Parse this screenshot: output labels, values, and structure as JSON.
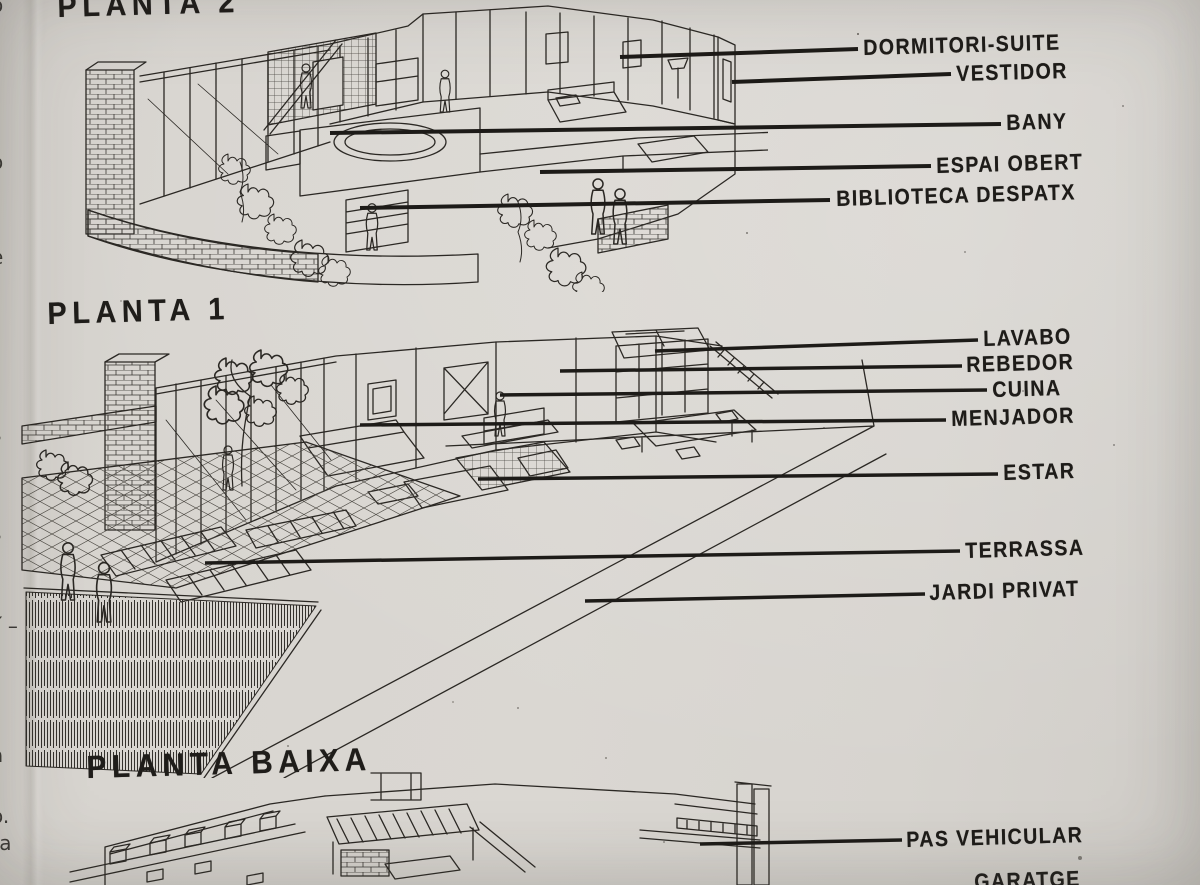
{
  "document": {
    "kind": "scanned architectural book page",
    "language": "Catalan"
  },
  "colors": {
    "paper": "#d7d4cf",
    "ink": "#2a2723",
    "leader_line": "#1d1b18"
  },
  "sections": [
    {
      "id": "planta-2",
      "title": "PLANTA 2",
      "labels": [
        {
          "text": "DORMITORI-SUITE"
        },
        {
          "text": "VESTIDOR"
        },
        {
          "text": "BANY"
        },
        {
          "text": "ESPAI OBERT"
        },
        {
          "text": "BIBLIOTECA DESPATX"
        }
      ]
    },
    {
      "id": "planta-1",
      "title": "PLANTA 1",
      "labels": [
        {
          "text": "LAVABO"
        },
        {
          "text": "REBEDOR"
        },
        {
          "text": "CUINA"
        },
        {
          "text": "MENJADOR"
        },
        {
          "text": "ESTAR"
        },
        {
          "text": "TERRASSA"
        },
        {
          "text": "JARDI PRIVAT"
        }
      ]
    },
    {
      "id": "planta-baixa",
      "title": "PLANTA BAIXA",
      "labels": [
        {
          "text": "PAS VEHICULAR"
        },
        {
          "text": "GARATGE"
        }
      ]
    }
  ],
  "left_margin_fragments": [
    {
      "text": "o"
    },
    {
      "text": "o"
    },
    {
      "text": "e"
    },
    {
      "text": "s"
    },
    {
      "text": "s"
    },
    {
      "text": "í –"
    },
    {
      "text": "a"
    },
    {
      "text": "o."
    },
    {
      "text": "ra"
    }
  ]
}
